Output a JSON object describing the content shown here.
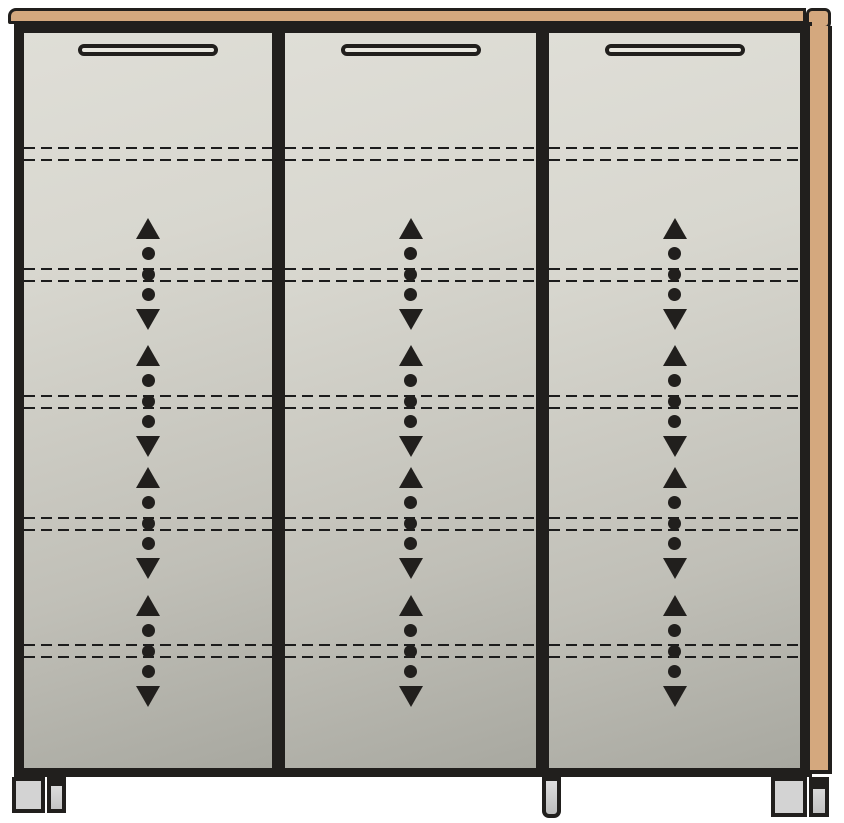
{
  "colors": {
    "background": "#ffffff",
    "outline": "#211f1d",
    "wood": "#d4a87e",
    "door_top": "#dfded7",
    "door_bottom": "#a8a8a0",
    "handle_fill": "#e9e8e1",
    "foot_fill": "#d3d3d3",
    "dash": "#1c1c1c"
  },
  "cabinet": {
    "type": "three-door cabinet, front elevation drawing",
    "door_count": 3,
    "doors": [
      {
        "id": "left",
        "x": 10,
        "width": 248
      },
      {
        "id": "middle",
        "x": 271,
        "width": 251
      },
      {
        "id": "right",
        "x": 535,
        "width": 251
      }
    ],
    "handle": {
      "width": 140,
      "height": 12,
      "top": 11
    },
    "shelf_line_offsets": [
      114,
      126,
      235,
      247,
      362,
      374,
      484,
      496,
      611,
      623
    ],
    "shelf_line_pairs": 5,
    "adjust_arrow_centers": [
      241,
      368,
      490,
      618
    ],
    "arrow_group": {
      "pattern": [
        "up-arrow-icon",
        "dot-icon",
        "dot-icon",
        "dot-icon",
        "down-arrow-icon"
      ],
      "meaning": "height-adjustable shelf indicator"
    },
    "feet": [
      {
        "id": "left",
        "parts": [
          "wide",
          "narrow"
        ]
      },
      {
        "id": "middle",
        "parts": [
          "post"
        ]
      },
      {
        "id": "right",
        "parts": [
          "wide",
          "narrow"
        ]
      }
    ]
  }
}
